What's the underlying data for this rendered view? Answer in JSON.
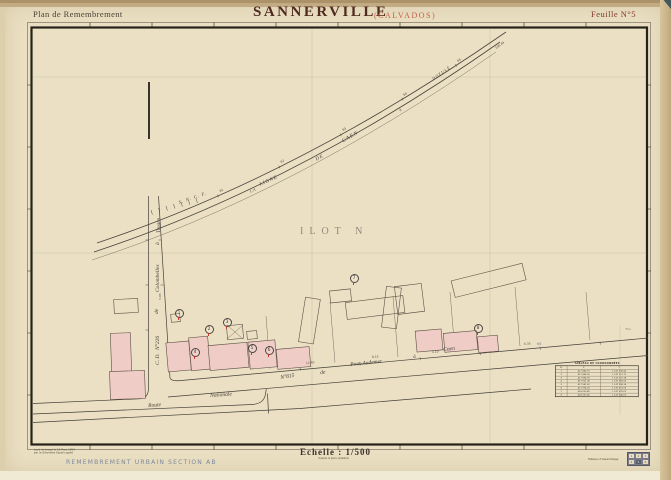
{
  "header": {
    "plan_label": "Plan de Remembrement",
    "commune": "SANNERVILLE",
    "departement": "(CALVADOS)",
    "sheet": "Feuille N°5"
  },
  "map": {
    "ilot": "ILOT  N",
    "railway": {
      "company": "S. N. C. F.",
      "words": [
        "LA",
        "LIGNE",
        "DE",
        "CAEN",
        "à",
        "DOZULÉ"
      ],
      "points": [
        "61",
        "62",
        "63",
        "64",
        "65"
      ],
      "end_mark": "100.44"
    },
    "cd_road": [
      "C. D.",
      "N°226",
      "de",
      "Colombelles",
      "à",
      "Troarn"
    ],
    "n815_road": [
      "N°815",
      "de",
      "Pont-Audemer",
      "à",
      "Caen"
    ],
    "route_nationale": [
      "Route",
      "Nationale"
    ],
    "parcels": [
      "1",
      "2",
      "3",
      "4",
      "5",
      "6",
      "7",
      "8"
    ],
    "dims": [
      "12.40",
      "8.15",
      "4.10",
      "6.35",
      "3.95"
    ],
    "notes": [
      "66",
      "35a"
    ]
  },
  "coord_table": {
    "title": "TABLEAU DE COORDONNÉES",
    "columns": [
      "N°",
      "X",
      "Y"
    ],
    "rows": [
      [
        "1",
        "417 842.15",
        "1 147 236.40"
      ],
      [
        "2",
        "417 868.30",
        "1 147 251.72"
      ],
      [
        "3",
        "417 894.55",
        "1 147 267.18"
      ],
      [
        "4",
        "417 921.06",
        "1 147 282.60"
      ],
      [
        "5",
        "417 947.62",
        "1 147 298.14"
      ],
      [
        "6",
        "417 974.20",
        "1 147 313.55"
      ],
      [
        "7",
        "418 000.85",
        "1 147 329.02"
      ],
      [
        "8",
        "418 027.40",
        "1 147 344.50"
      ]
    ]
  },
  "footer": {
    "survey_line1": "Levé et dressé le 15 Mars 1954",
    "survey_line2": "par le Géomètre Expert agréé",
    "section": "REMEMBREMENT   URBAIN   SECTION   AB",
    "scale": "Echelle : 1/500",
    "scale_note": "d'après le plan cadastral",
    "assemblage": "Tableau d'assemblage",
    "cells": [
      "1",
      "2",
      "3",
      "4",
      "5",
      "6"
    ]
  },
  "colors": {
    "paper": "#ebe0c3",
    "frame": "#262219",
    "ink": "#45403a",
    "title_maroon": "#50291f",
    "title_red": "#7e352a",
    "calvados_orange": "#c4614a",
    "building_pink": "#efccc6",
    "mark_red": "#c0392b",
    "section_blue": "#7b889c"
  }
}
